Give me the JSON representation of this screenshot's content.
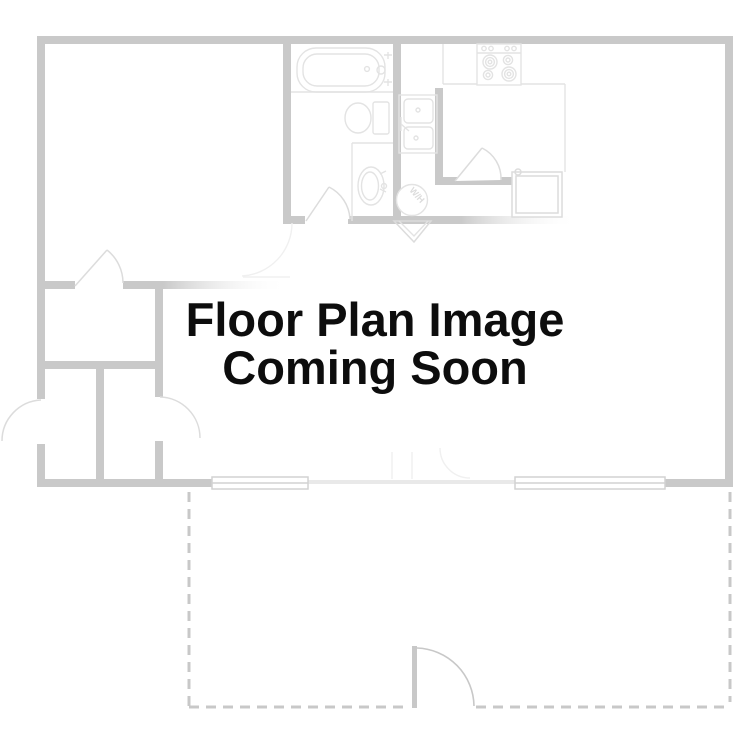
{
  "watermark": {
    "line1": "Floor Plan Image",
    "line2": "Coming Soon"
  },
  "floor_plan": {
    "water_heater_label": "W/H"
  },
  "colors": {
    "wall": "#c9c9c9",
    "wall_faint": "#e9e9e9",
    "fixture": "#e3e3e3",
    "fixture_strong": "#dcdcdc",
    "faint": "#f0f0f0",
    "dashed": "#c8c8c8",
    "window_frame": "#d2d2d2",
    "text": "#0d0d0d"
  }
}
